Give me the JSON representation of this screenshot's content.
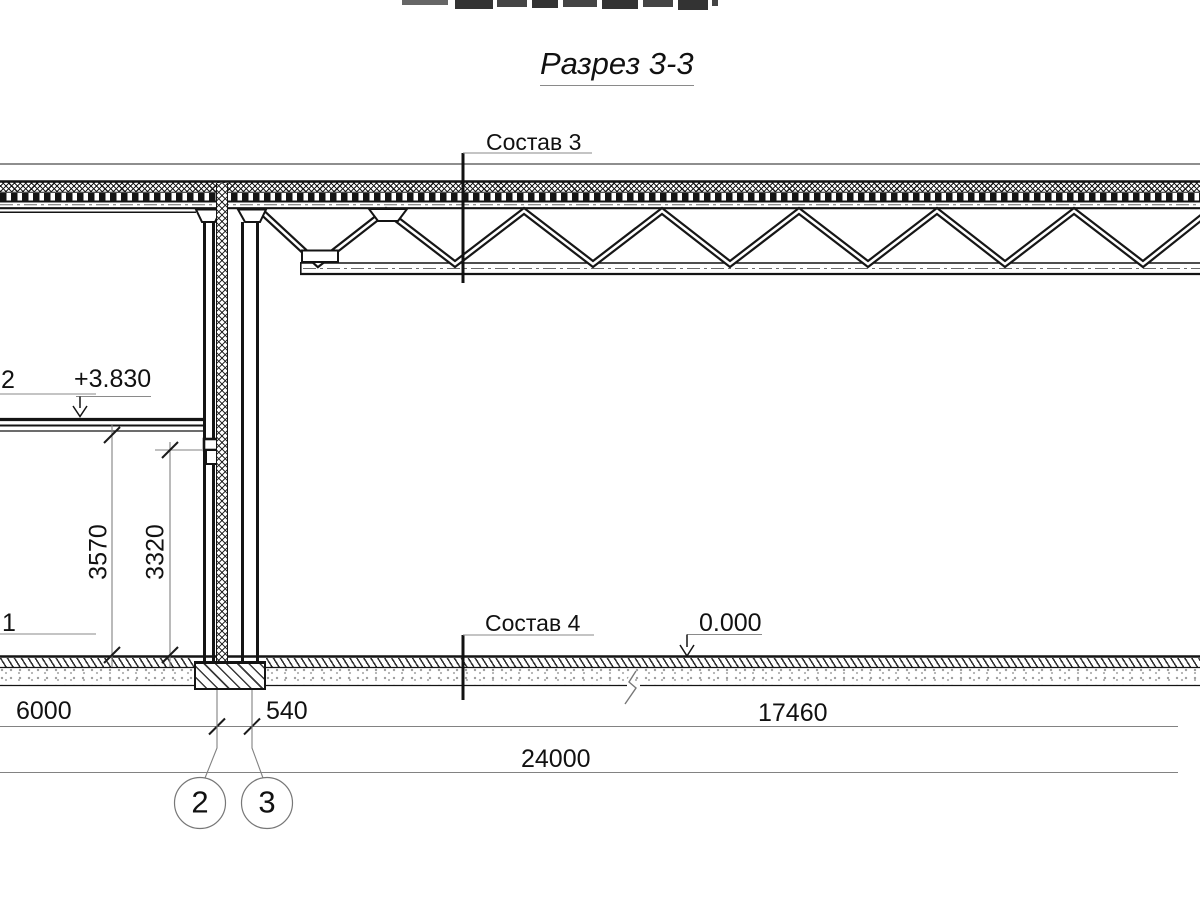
{
  "drawing": {
    "title": "Разрез 3-3",
    "labels": {
      "sostav3": "Состав 3",
      "sostav4": "Состав 4"
    },
    "levels": {
      "second_floor": "+3.830",
      "ground_floor": "0.000"
    },
    "edge_callouts": {
      "upper": "2",
      "lower": "1"
    },
    "dimensions": {
      "floor_height_outer": "3570",
      "floor_height_inner": "3320",
      "bay_left": "6000",
      "wall_offset": "540",
      "hall_span": "17460",
      "total_span": "24000"
    },
    "grid_axes": {
      "axis_2": "2",
      "axis_3": "3"
    },
    "colors": {
      "line": "#1a1a1a",
      "dim": "#828282",
      "background": "#ffffff"
    }
  }
}
